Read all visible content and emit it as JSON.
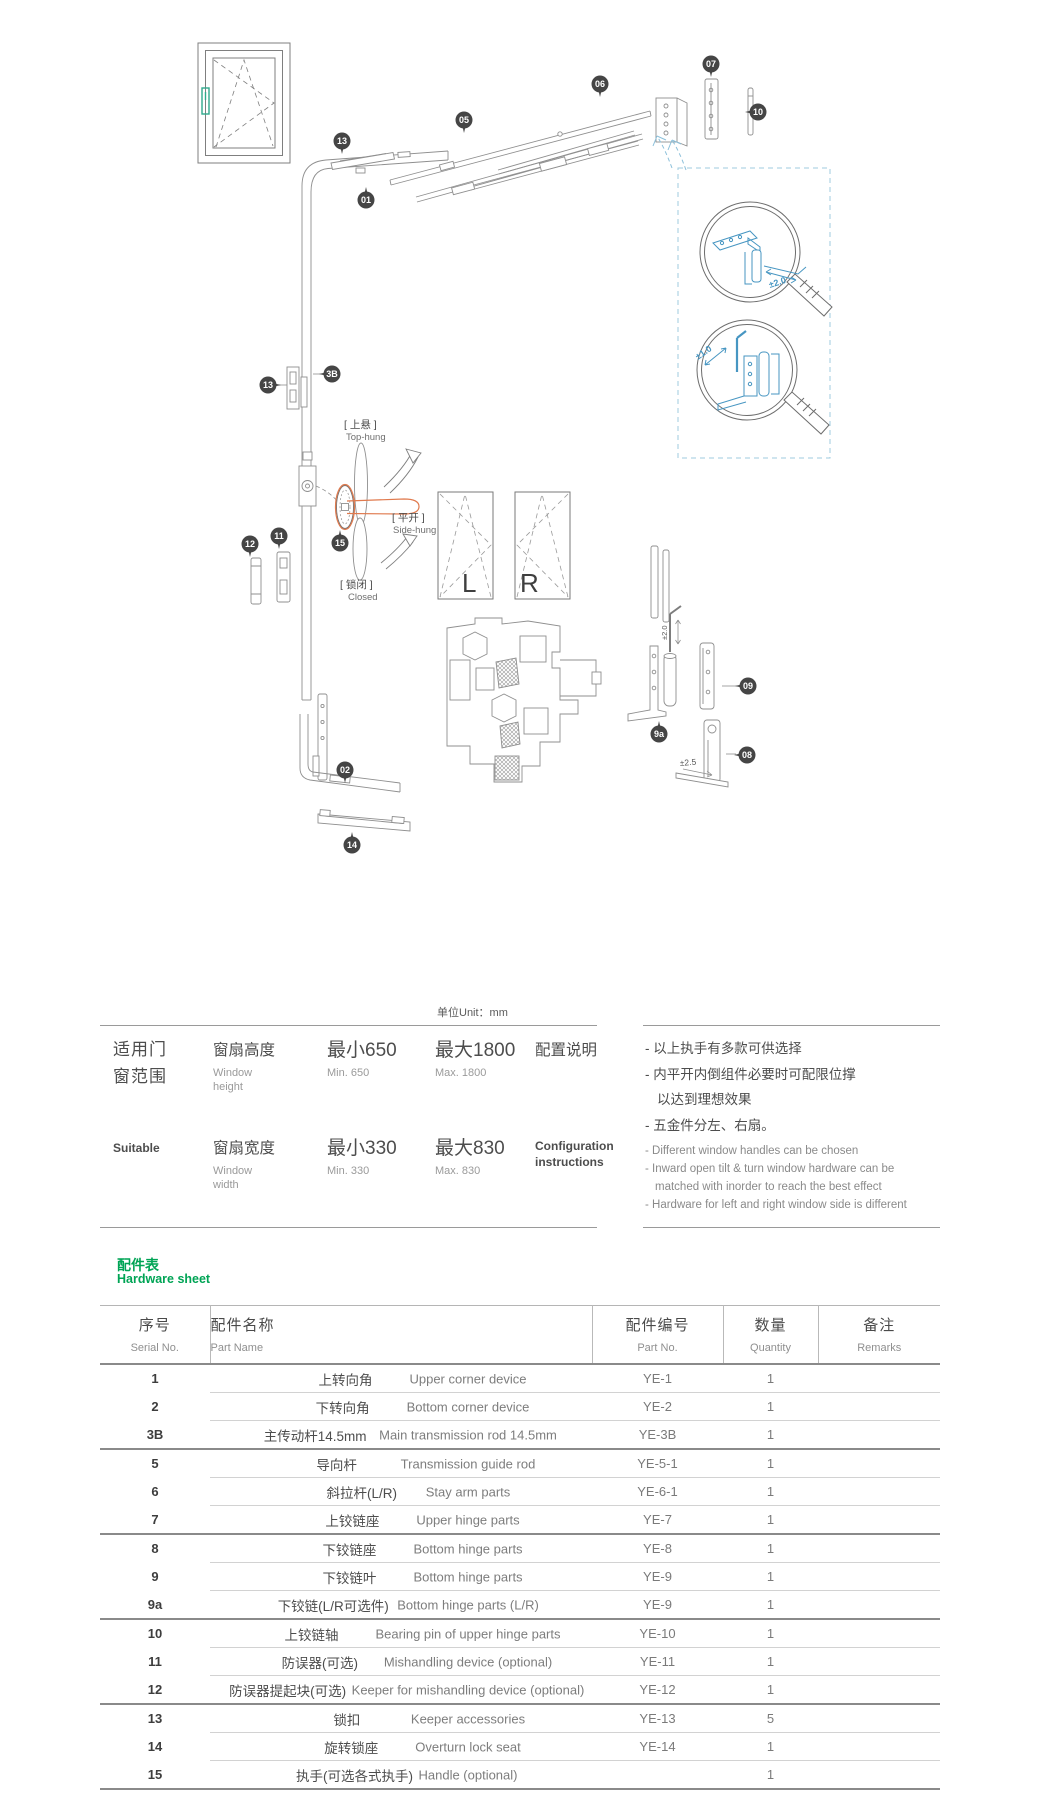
{
  "diagram": {
    "labels": {
      "top_hung_cn": "[ 上悬 ]",
      "top_hung_en": "Top-hung",
      "side_hung_cn": "[ 平开 ]",
      "side_hung_en": "Side-hung",
      "closed_cn": "[ 锁闭 ]",
      "closed_en": "Closed",
      "left": "L",
      "right": "R",
      "adj_top": "±2.0",
      "adj_bottom": "±1.0",
      "adj_hinge": "±2.0",
      "adj_rod": "±2.5"
    },
    "balloon_color": "#454545",
    "detail_color": "#4796c2",
    "handle_color": "#e07a4e",
    "icon_handle_color": "#2fa98b",
    "balloons": [
      {
        "label": "07",
        "x": 711,
        "y": 64,
        "tail": "d"
      },
      {
        "label": "06",
        "x": 600,
        "y": 84,
        "tail": "d"
      },
      {
        "label": "10",
        "x": 758,
        "y": 112,
        "tail": "l"
      },
      {
        "label": "05",
        "x": 464,
        "y": 120,
        "tail": "d"
      },
      {
        "label": "13",
        "x": 342,
        "y": 141,
        "tail": "d"
      },
      {
        "label": "01",
        "x": 366,
        "y": 200,
        "tail": "u"
      },
      {
        "label": "13",
        "x": 268,
        "y": 385,
        "tail": "r"
      },
      {
        "label": "3B",
        "x": 332,
        "y": 374,
        "tail": "l"
      },
      {
        "label": "11",
        "x": 279,
        "y": 536,
        "tail": "d"
      },
      {
        "label": "12",
        "x": 250,
        "y": 544,
        "tail": "d"
      },
      {
        "label": "15",
        "x": 340,
        "y": 543,
        "tail": "u"
      },
      {
        "label": "02",
        "x": 345,
        "y": 770,
        "tail": "d"
      },
      {
        "label": "14",
        "x": 352,
        "y": 845,
        "tail": "u"
      },
      {
        "label": "9a",
        "x": 659,
        "y": 734,
        "tail": "u"
      },
      {
        "label": "09",
        "x": 748,
        "y": 686,
        "tail": "l"
      },
      {
        "label": "08",
        "x": 747,
        "y": 755,
        "tail": "l"
      }
    ]
  },
  "spec": {
    "unit": "单位Unit：mm",
    "section_cn_line1": "适用门",
    "section_cn_line2": "窗范围",
    "section_en": "Suitable",
    "rows": [
      {
        "param_cn": "窗扇高度",
        "param_en": "Window height",
        "min_cn": "最小650",
        "min_en": "Min. 650",
        "max_cn": "最大1800",
        "max_en": "Max. 1800"
      },
      {
        "param_cn": "窗扇宽度",
        "param_en": "Window width",
        "min_cn": "最小330",
        "min_en": "Min. 330",
        "max_cn": "最大830",
        "max_en": "Max. 830"
      }
    ],
    "config_title_cn": "配置说明",
    "config_title_en_line1": "Configuration",
    "config_title_en_line2": "instructions",
    "config_cn_items": [
      "- 以上执手有多款可供选择",
      "- 内平开内倒组件必要时可配限位撑",
      "以达到理想效果",
      "- 五金件分左、右扇。"
    ],
    "config_en_items": [
      "- Different window handles can be chosen",
      "- Inward open tilt & turn window hardware can be",
      "matched with inorder to reach the best effect",
      "- Hardware for left and right window side is different"
    ]
  },
  "hardware": {
    "title_cn": "配件表",
    "title_en": "Hardware sheet",
    "headers": {
      "serial_cn": "序号",
      "serial_en": "Serial No.",
      "name_cn": "配件名称",
      "name_en": "Part Name",
      "pn_cn": "配件编号",
      "pn_en": "Part No.",
      "qty_cn": "数量",
      "qty_en": "Quantity",
      "rem_cn": "备注",
      "rem_en": "Remarks"
    },
    "rows": [
      {
        "serial": "1",
        "name_cn": "上转向角",
        "name_en": "Upper corner device",
        "part_no": "YE-1",
        "qty": "1",
        "remarks": "",
        "group_start": false
      },
      {
        "serial": "2",
        "name_cn": "下转向角",
        "name_en": "Bottom corner device",
        "part_no": "YE-2",
        "qty": "1",
        "remarks": "",
        "group_start": false
      },
      {
        "serial": "3B",
        "name_cn": "主传动杆14.5mm",
        "name_en": "Main transmission rod 14.5mm",
        "part_no": "YE-3B",
        "qty": "1",
        "remarks": "",
        "group_start": false
      },
      {
        "serial": "5",
        "name_cn": "导向杆",
        "name_en": "Transmission guide rod",
        "part_no": "YE-5-1",
        "qty": "1",
        "remarks": "",
        "group_start": true
      },
      {
        "serial": "6",
        "name_cn": "斜拉杆(L/R)",
        "name_en": "Stay arm parts",
        "part_no": "YE-6-1",
        "qty": "1",
        "remarks": "",
        "group_start": false
      },
      {
        "serial": "7",
        "name_cn": "上铰链座",
        "name_en": "Upper hinge parts",
        "part_no": "YE-7",
        "qty": "1",
        "remarks": "",
        "group_start": false
      },
      {
        "serial": "8",
        "name_cn": "下铰链座",
        "name_en": "Bottom hinge parts",
        "part_no": "YE-8",
        "qty": "1",
        "remarks": "",
        "group_start": true
      },
      {
        "serial": "9",
        "name_cn": "下铰链叶",
        "name_en": "Bottom hinge parts",
        "part_no": "YE-9",
        "qty": "1",
        "remarks": "",
        "group_start": false
      },
      {
        "serial": "9a",
        "name_cn": "下铰链(L/R可选件)",
        "name_en": "Bottom hinge parts (L/R)",
        "part_no": "YE-9",
        "qty": "1",
        "remarks": "",
        "group_start": false
      },
      {
        "serial": "10",
        "name_cn": "上铰链轴",
        "name_en": "Bearing pin of upper hinge parts",
        "part_no": "YE-10",
        "qty": "1",
        "remarks": "",
        "group_start": true
      },
      {
        "serial": "11",
        "name_cn": "防误器(可选)",
        "name_en": "Mishandling device (optional)",
        "part_no": "YE-11",
        "qty": "1",
        "remarks": "",
        "group_start": false
      },
      {
        "serial": "12",
        "name_cn": "防误器提起块(可选)",
        "name_en": "Keeper for mishandling device (optional)",
        "part_no": "YE-12",
        "qty": "1",
        "remarks": "",
        "group_start": false
      },
      {
        "serial": "13",
        "name_cn": "锁扣",
        "name_en": "Keeper accessories",
        "part_no": "YE-13",
        "qty": "5",
        "remarks": "",
        "group_start": true
      },
      {
        "serial": "14",
        "name_cn": "旋转锁座",
        "name_en": "Overturn lock seat",
        "part_no": "YE-14",
        "qty": "1",
        "remarks": "",
        "group_start": false
      },
      {
        "serial": "15",
        "name_cn": "执手(可选各式执手)",
        "name_en": "Handle (optional)",
        "part_no": "",
        "qty": "1",
        "remarks": "",
        "group_start": false
      }
    ]
  }
}
